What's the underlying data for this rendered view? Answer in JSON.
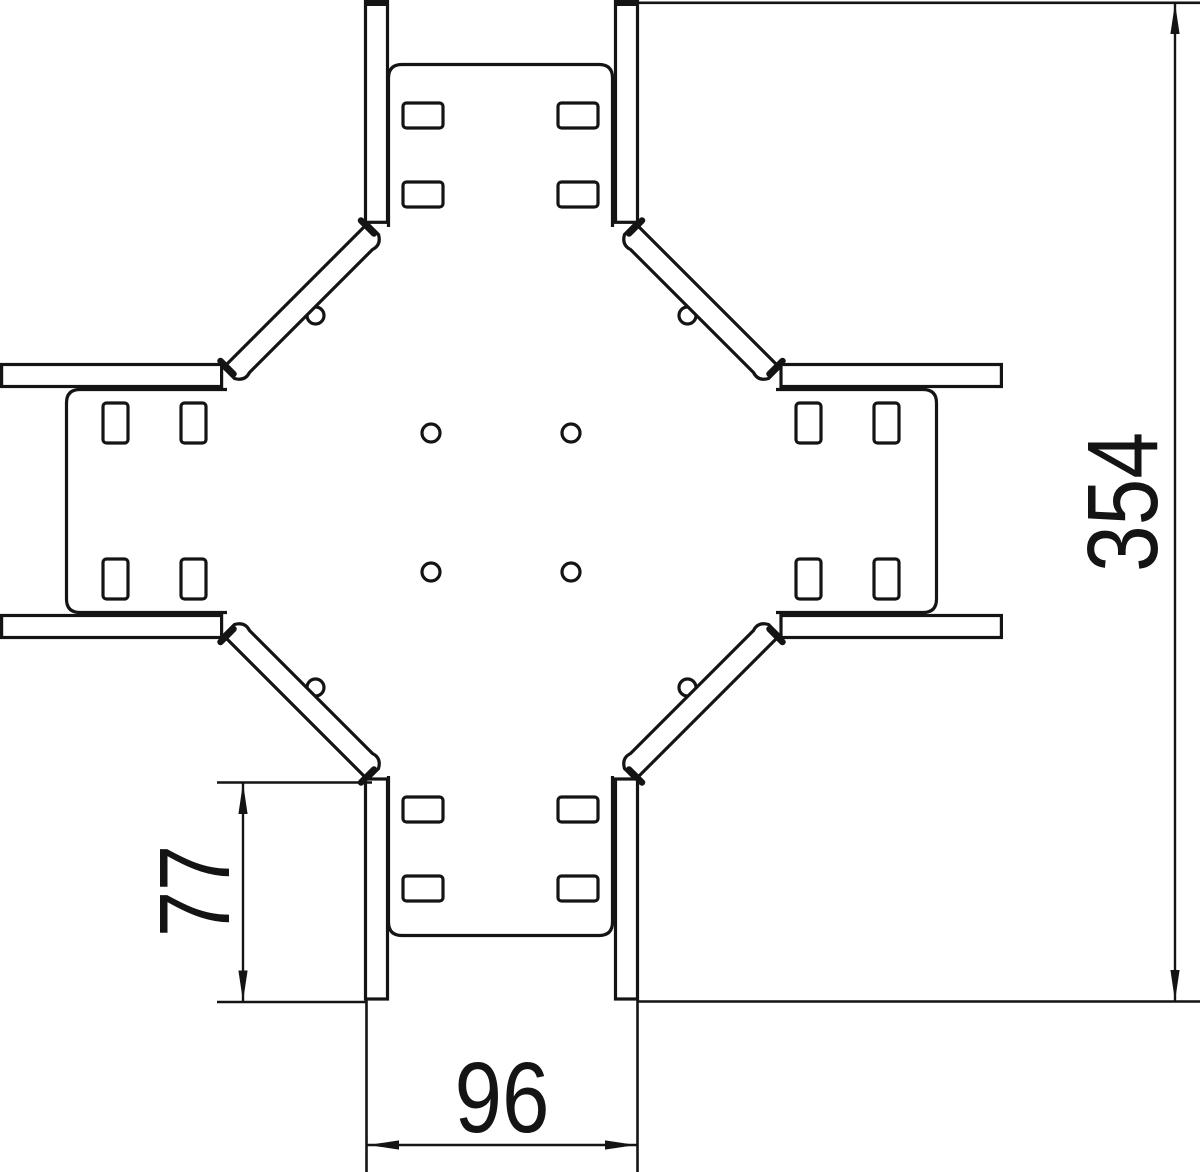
{
  "drawing": {
    "background": "#ffffff",
    "line_color": "#141414",
    "dimensions": {
      "overall_length": {
        "value": "354"
      },
      "branch_straight_length": {
        "value": "77"
      },
      "end_width": {
        "value": "96"
      }
    }
  }
}
